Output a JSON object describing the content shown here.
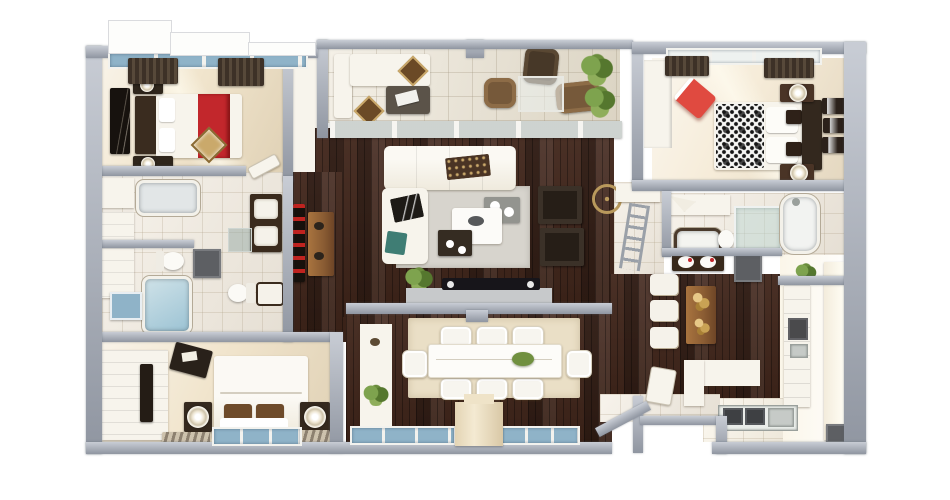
{
  "scene": {
    "type": "3d-floor-plan-render",
    "view": "top-down",
    "background": "#ffffff",
    "visible_text": "none"
  },
  "palette": {
    "wall": "#a7aebb",
    "wood": "#40251a",
    "carpet": "#f1e5cd",
    "carpet_bright": "#f6ecd9",
    "tile": "#f2ebdf",
    "balcony_tile": "#e9e1cf",
    "kitchen_floor": "#faf4e6",
    "glass_blue": "#8fb3c8",
    "accent_red": "#c2272c",
    "chair_red": "#e04a40",
    "plant_green": "#70903f",
    "furniture_white": "#f7f4ec",
    "furniture_dark": "#261e17",
    "warm_wood": "#a06a38",
    "gray_mat": "#5d5f63",
    "rug_gray": "#d7d4cd",
    "rug_cream": "#eadfc6",
    "pillow_brown": "#6e4b2a",
    "exterior_step_white": "#fdfdfb"
  },
  "rooms": [
    {
      "id": "bedroom-top-left",
      "floor": "cream-carpet",
      "furniture": [
        "double-bed-white-red-runner",
        "dark-headboard",
        "2-nightstands-with-lamps",
        "wall-art",
        "gold-diamond-pillow",
        "window-with-curtains"
      ]
    },
    {
      "id": "bathroom-ensuite-left",
      "floor": "tile",
      "furniture": [
        "bathtub",
        "double-sink-dark-vanity",
        "toilet",
        "gray-shower-square",
        "white-cabinet"
      ]
    },
    {
      "id": "bathroom-second-left",
      "floor": "tile",
      "furniture": [
        "soaking-tub-blue-water",
        "blue-bath-mat",
        "toilet",
        "sink"
      ]
    },
    {
      "id": "bedroom-bottom-left",
      "floor": "cream-carpet",
      "furniture": [
        "double-bed-brown-pillows",
        "white-wardrobe",
        "2-nightstands-with-disc-lamps",
        "tilted-valet-panel",
        "2-striped-rugs",
        "bottom-window"
      ]
    },
    {
      "id": "hallway-left",
      "floor": "dark-hardwood",
      "furniture": [
        "wood-console-table",
        "red-wine-rack"
      ]
    },
    {
      "id": "balcony",
      "floor": "outdoor-tile",
      "furniture": [
        "white-outdoor-sofa",
        "2-diamond-cushions",
        "dark-coffee-table",
        "3-wicker-chairs",
        "glass-table",
        "plants",
        "glass-railing"
      ]
    },
    {
      "id": "living-room",
      "floor": "dark-hardwood",
      "furniture": [
        "white-sectional-sofa",
        "area-rug",
        "white-coffee-table",
        "gray-side-table",
        "dark-tray-table",
        "2-dark-armchairs",
        "tv-console-with-tv",
        "plant",
        "ceiling-fan-ring"
      ]
    },
    {
      "id": "bedroom-top-right",
      "floor": "cream-carpet",
      "furniture": [
        "double-bed-damask-throw",
        "dark-headboard",
        "red-accent-chair",
        "white-wardrobe",
        "2-nightstands-with-disc-lamps",
        "3-leaning-picture-frames",
        "window-with-curtains"
      ]
    },
    {
      "id": "bathroom-right",
      "floor": "tile",
      "furniture": [
        "freestanding-tub",
        "glass-shower",
        "small-dark-rim-tub",
        "toilet",
        "double-sink-dark-vanity",
        "gray-shower-mat"
      ]
    },
    {
      "id": "stair-nook",
      "floor": "tile",
      "furniture": [
        "leaning-ladder"
      ]
    },
    {
      "id": "bar-nook",
      "floor": "dark-hardwood",
      "furniture": [
        "wood-bar-counter",
        "gold-flower-decor",
        "3-white-stools"
      ]
    },
    {
      "id": "kitchen",
      "floor": "hardwood-and-bright-tile",
      "furniture": [
        "tall-cabinet-column",
        "built-in-oven",
        "bright-cabinet-wall",
        "plant",
        "bottom-counter-2-burners",
        "steel-sink",
        "white-l-counter",
        "2-gray-mats"
      ]
    },
    {
      "id": "dining-room",
      "floor": "dark-hardwood",
      "furniture": [
        "cream-area-rug",
        "white-dining-table",
        "8-white-chairs",
        "green-centerpiece",
        "white-buffet-with-plant",
        "bottom-windows",
        "chimney-pillar"
      ]
    },
    {
      "id": "entry",
      "floor": "tile",
      "furniture": [
        "open-white-door",
        "angled-wall",
        "landing-step"
      ]
    }
  ],
  "exterior": {
    "top_left_steps": 3,
    "outline": "gray-perimeter-wall-with-bottom-notch"
  }
}
